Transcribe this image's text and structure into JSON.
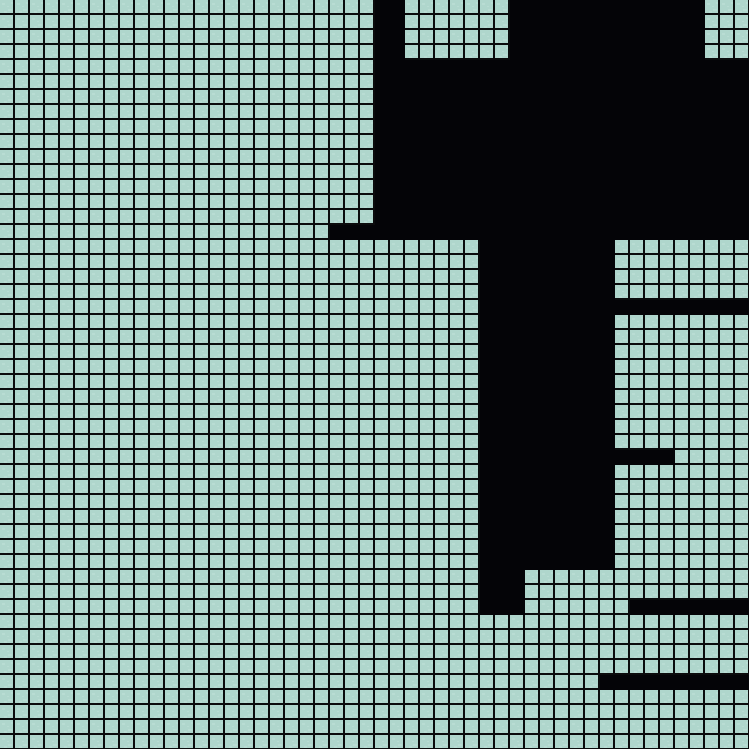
{
  "canvas": {
    "description": "zoomed pixel grid canvas with black filled region",
    "width_px": 749,
    "height_px": 749,
    "grid": {
      "columns": 50,
      "rows": 50,
      "cell_pitch_px": 15,
      "cell_fill_px": 13,
      "line_px": 2
    },
    "colors": {
      "cell_fill": "#afd6cc",
      "cell_speckle": "#c6e4db",
      "grid_line": "#0b0b0c",
      "filled_region": "#040407"
    },
    "filled_segments": [
      {
        "row_start": 0,
        "row_end": 3,
        "col_start": 25,
        "col_end": 26
      },
      {
        "row_start": 0,
        "row_end": 3,
        "col_start": 34,
        "col_end": 46
      },
      {
        "row_start": 4,
        "row_end": 14,
        "col_start": 25,
        "col_end": 49
      },
      {
        "row_start": 15,
        "row_end": 15,
        "col_start": 22,
        "col_end": 49
      },
      {
        "row_start": 16,
        "row_end": 37,
        "col_start": 32,
        "col_end": 40
      },
      {
        "row_start": 20,
        "row_end": 20,
        "col_start": 41,
        "col_end": 49
      },
      {
        "row_start": 30,
        "row_end": 30,
        "col_start": 41,
        "col_end": 44
      },
      {
        "row_start": 38,
        "row_end": 40,
        "col_start": 32,
        "col_end": 34
      },
      {
        "row_start": 40,
        "row_end": 40,
        "col_start": 42,
        "col_end": 49
      },
      {
        "row_start": 45,
        "row_end": 45,
        "col_start": 40,
        "col_end": 49
      }
    ]
  }
}
